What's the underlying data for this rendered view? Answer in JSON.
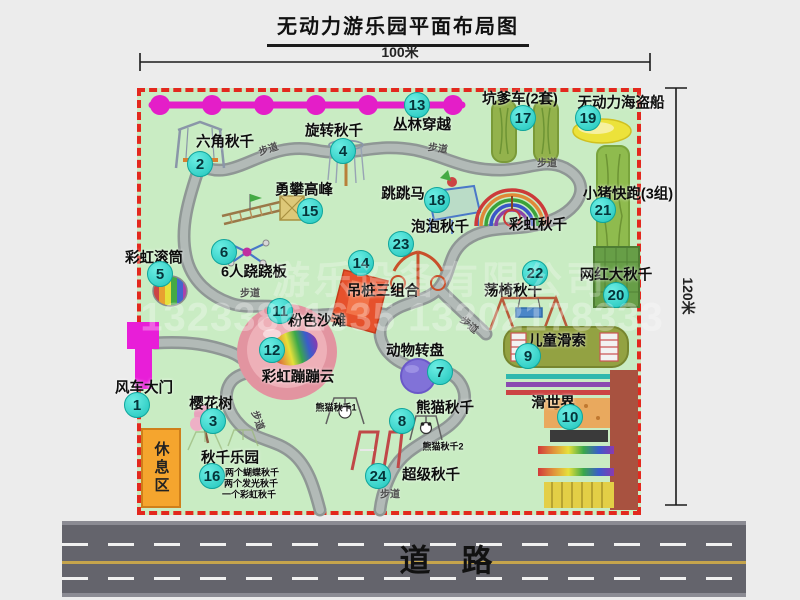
{
  "title": "无动力游乐园平面布局图",
  "dimensions": {
    "width_label": "100米",
    "height_label": "120米"
  },
  "road": {
    "label": "道　路"
  },
  "watermark": {
    "company": "游乐设备有限公司",
    "phone": "13233861635 13202178333"
  },
  "rest_area": {
    "label": "休息区"
  },
  "colors": {
    "map_bg": "#c9ecc3",
    "border_red": "#e3281e",
    "badge_teal": "#1fc4bb",
    "chain_magenta": "#e41ec8",
    "gate_magenta": "#e81ed8",
    "rest_orange": "#f5a52e",
    "road_gray": "#64646c",
    "path_gray": "#a8b0ad"
  },
  "attractions": [
    {
      "num": "1",
      "name": "风车大门",
      "bx": 137,
      "by": 405,
      "lx": 144,
      "ly": 387
    },
    {
      "num": "2",
      "name": "六角秋千",
      "bx": 200,
      "by": 164,
      "lx": 225,
      "ly": 141
    },
    {
      "num": "3",
      "name": "樱花树",
      "bx": 213,
      "by": 421,
      "lx": 211,
      "ly": 403
    },
    {
      "num": "4",
      "name": "旋转秋千",
      "bx": 343,
      "by": 151,
      "lx": 334,
      "ly": 130
    },
    {
      "num": "5",
      "name": "彩虹滚筒",
      "bx": 160,
      "by": 274,
      "lx": 154,
      "ly": 257
    },
    {
      "num": "6",
      "name": "6人跷跷板",
      "bx": 224,
      "by": 252,
      "lx": 254,
      "ly": 271
    },
    {
      "num": "7",
      "name": "动物转盘",
      "bx": 440,
      "by": 372,
      "lx": 415,
      "ly": 350
    },
    {
      "num": "8",
      "name": "熊猫秋千",
      "bx": 402,
      "by": 421,
      "lx": 445,
      "ly": 407
    },
    {
      "num": "9",
      "name": "儿童滑索",
      "bx": 528,
      "by": 356,
      "lx": 557,
      "ly": 340
    },
    {
      "num": "10",
      "name": "滑世界",
      "bx": 570,
      "by": 417,
      "lx": 553,
      "ly": 402
    },
    {
      "num": "11",
      "name": "粉色沙滩",
      "bx": 280,
      "by": 311,
      "lx": 317,
      "ly": 320
    },
    {
      "num": "12",
      "name": "彩虹蹦蹦云",
      "bx": 272,
      "by": 350,
      "lx": 298,
      "ly": 376
    },
    {
      "num": "13",
      "name": "丛林穿越",
      "bx": 417,
      "by": 105,
      "lx": 422,
      "ly": 124
    },
    {
      "num": "14",
      "name": "吊桩三组合",
      "bx": 361,
      "by": 263,
      "lx": 383,
      "ly": 290
    },
    {
      "num": "15",
      "name": "勇攀高峰",
      "bx": 310,
      "by": 211,
      "lx": 304,
      "ly": 189
    },
    {
      "num": "16",
      "name": "秋千乐园",
      "bx": 212,
      "by": 476,
      "lx": 230,
      "ly": 457
    },
    {
      "num": "17",
      "name": "坑爹车(2套)",
      "bx": 523,
      "by": 118,
      "lx": 520,
      "ly": 98
    },
    {
      "num": "18",
      "name": "跳跳马",
      "bx": 437,
      "by": 200,
      "lx": 403,
      "ly": 193
    },
    {
      "num": "19",
      "name": "无动力海盗船",
      "bx": 588,
      "by": 118,
      "lx": 621,
      "ly": 102
    },
    {
      "num": "20",
      "name": "网红大秋千",
      "bx": 616,
      "by": 295,
      "lx": 616,
      "ly": 274
    },
    {
      "num": "21",
      "name": "小猪快跑(3组)",
      "bx": 603,
      "by": 210,
      "lx": 628,
      "ly": 193
    },
    {
      "num": "22",
      "name": "荡椅秋千",
      "bx": 535,
      "by": 273,
      "lx": 513,
      "ly": 290
    },
    {
      "num": "23",
      "name": "泡泡秋千",
      "bx": 401,
      "by": 244,
      "lx": 440,
      "ly": 226
    },
    {
      "num": "24",
      "name": "超级秋千",
      "bx": 378,
      "by": 476,
      "lx": 431,
      "ly": 474
    }
  ],
  "plain_labels": [
    {
      "text": "彩虹秋千",
      "x": 538,
      "y": 224,
      "small": false
    },
    {
      "text": "熊猫秋千1",
      "x": 336,
      "y": 407,
      "small": true
    },
    {
      "text": "熊猫秋千2",
      "x": 443,
      "y": 446,
      "small": true
    },
    {
      "text": "两个蝴蝶秋千",
      "x": 252,
      "y": 472,
      "small": true
    },
    {
      "text": "两个发光秋千",
      "x": 251,
      "y": 483,
      "small": true
    },
    {
      "text": "一个彩虹秋千",
      "x": 249,
      "y": 494,
      "small": true
    }
  ],
  "path_labels": [
    {
      "text": "步道",
      "x": 268,
      "y": 148,
      "r": -18
    },
    {
      "text": "步道",
      "x": 438,
      "y": 147,
      "r": 8
    },
    {
      "text": "步道",
      "x": 547,
      "y": 162,
      "r": 0
    },
    {
      "text": "步道",
      "x": 250,
      "y": 292,
      "r": 0
    },
    {
      "text": "步道",
      "x": 470,
      "y": 324,
      "r": 40
    },
    {
      "text": "步道",
      "x": 259,
      "y": 420,
      "r": 70
    },
    {
      "text": "步道",
      "x": 390,
      "y": 493,
      "r": 0
    }
  ]
}
